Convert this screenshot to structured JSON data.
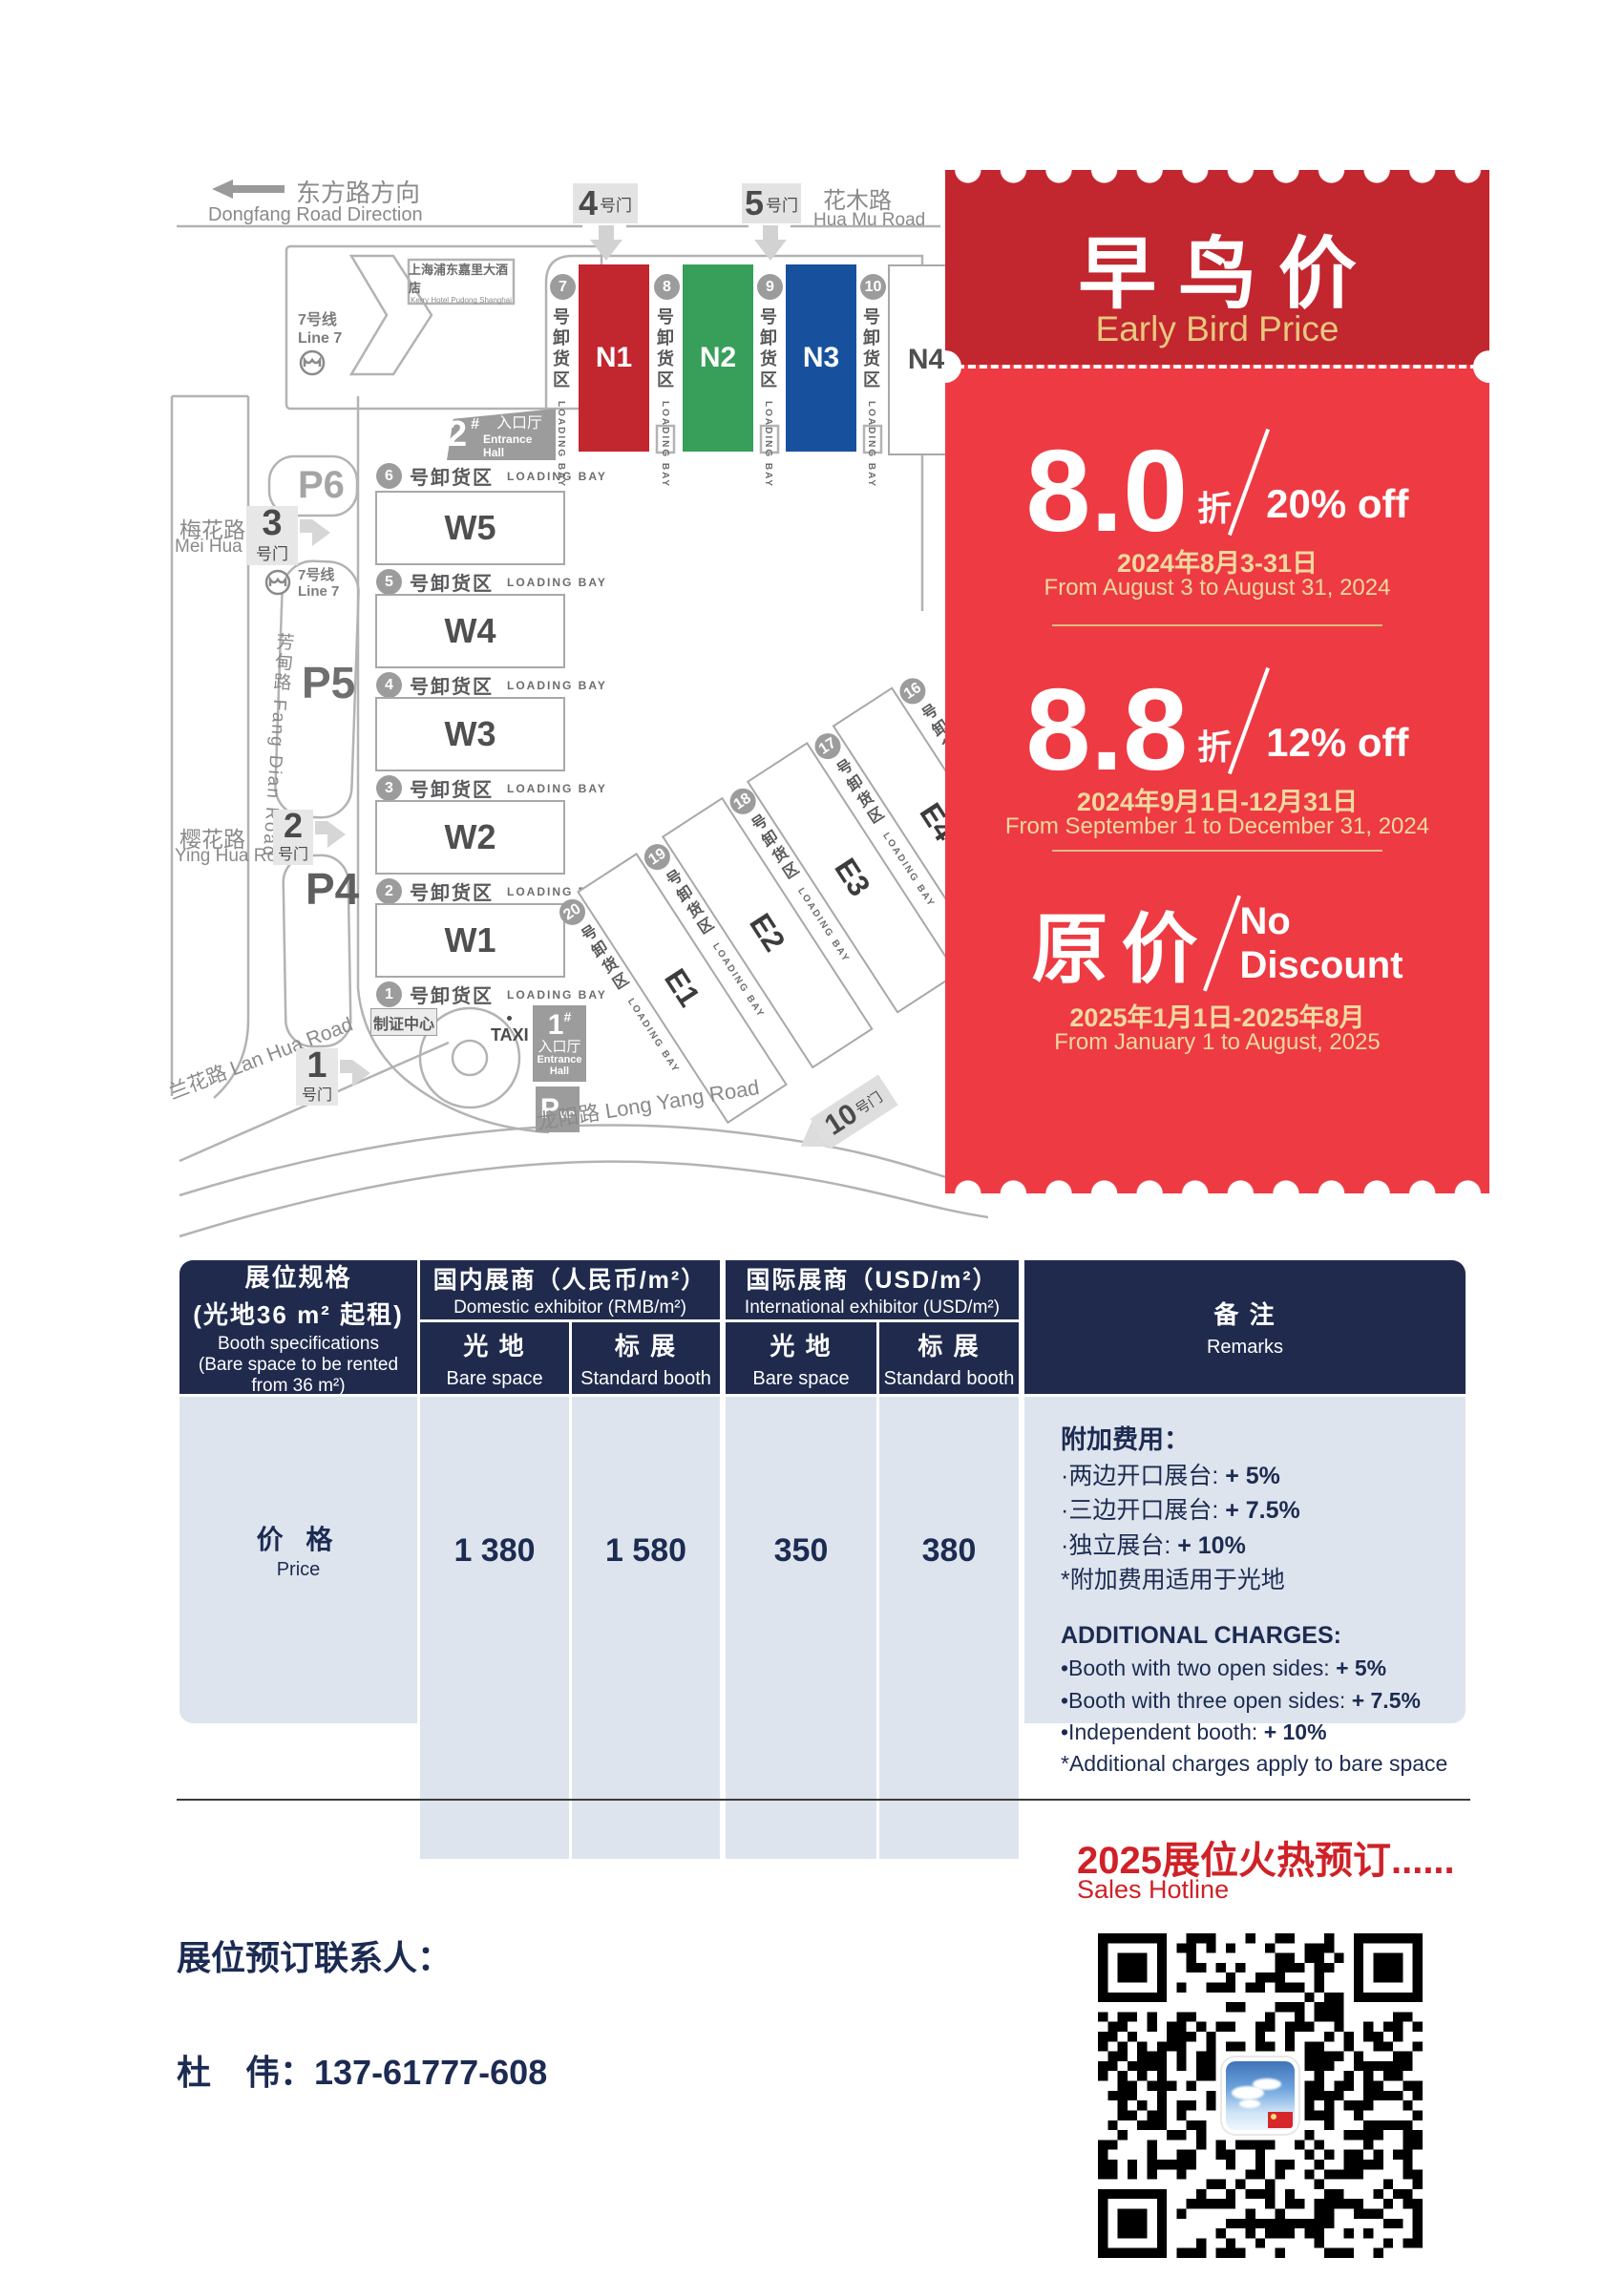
{
  "map": {
    "direction_cn": "东方路方向",
    "direction_en": "Dongfang Road Direction",
    "huamu_cn": "花木路",
    "huamu_en": "Hua Mu Road",
    "meihua_cn": "梅花路",
    "meihua_en": "Mei Hua Road",
    "yinghua_cn": "樱花路",
    "yinghua_en": "Ying Hua Road",
    "lanhua": "兰花路 Lan Hua Road",
    "fangdian": "芳甸路 Fang Dian Road",
    "longyang": "龙阳路  Long Yang Road",
    "metro_cn": "7号线",
    "metro_en": "Line 7",
    "hotel_cn": "上海浦东嘉里大酒店",
    "hotel_en": "Kerry Hotel Pudong Shanghai",
    "gate_suffix": "号门",
    "gates": {
      "g1": "1",
      "g2": "2",
      "g3": "3",
      "g4": "4",
      "g5": "5",
      "g10": "10"
    },
    "parking": {
      "p4": "P4",
      "p5": "P5",
      "p6": "P6",
      "vip_p": "P",
      "vip_sub": "VIP"
    },
    "entrance2_num": "2",
    "entrance1_num": "1",
    "entrance_hash": "#",
    "entrance_cn": "入口厅",
    "entrance_en": "Entrance Hall",
    "badge_center": "制证中心",
    "taxi": "TAXI",
    "bay_cn": "号卸货区",
    "bay_en": "LOADING BAY",
    "n": {
      "b1": "7",
      "h1": "N1",
      "b2": "8",
      "h2": "N2",
      "b3": "9",
      "h3": "N3",
      "b4": "10",
      "h4": "N4"
    },
    "w": {
      "b1": "6",
      "h1": "W5",
      "b2": "5",
      "h2": "W4",
      "b3": "4",
      "h3": "W3",
      "b4": "3",
      "h4": "W2",
      "b5": "2",
      "h5": "W1",
      "b6": "1"
    },
    "e": {
      "b1": "20",
      "h1": "E1",
      "b2": "19",
      "h2": "E2",
      "b3": "18",
      "h3": "E3",
      "b4": "17",
      "h4": "E4",
      "b5": "16"
    },
    "hall_colors": {
      "n1": "#c2262e",
      "n2": "#379f5a",
      "n3": "#17519e"
    }
  },
  "coupon": {
    "title_cn": "早 鸟 价",
    "title_en": "Early Bird Price",
    "tier1": {
      "big": "8.0",
      "unit": "折",
      "off": "20% off",
      "date_cn": "2024年8月3-31日",
      "date_en": "From August 3 to August 31, 2024"
    },
    "tier2": {
      "big": "8.8",
      "unit": "折",
      "off": "12% off",
      "date_cn": "2024年9月1日-12月31日",
      "date_en": "From September 1 to December 31, 2024"
    },
    "tier3": {
      "big": "原价",
      "off1": "No",
      "off2": "Discount",
      "date_cn": "2025年1月1日-2025年8月",
      "date_en": "From January 1 to August, 2025"
    },
    "colors": {
      "dark_red": "#c2262e",
      "bright_red": "#ee3a42",
      "gold": "#e7c87f"
    }
  },
  "pricing_table": {
    "spec": {
      "l1": "展位规格",
      "l2": "(光地36 m² 起租)",
      "l3": "Booth specifications",
      "l4": "(Bare space to be rented",
      "l5": "from 36 m²)"
    },
    "group_domestic_cn": "国内展商（人民币/m²）",
    "group_domestic_en": "Domestic exhibitor (RMB/m²)",
    "group_intl_cn": "国际展商（USD/m²）",
    "group_intl_en": "International exhibitor (USD/m²)",
    "col_bare_cn": "光 地",
    "col_bare_en": "Bare space",
    "col_std_cn": "标 展",
    "col_std_en": "Standard booth",
    "remarks_cn": "备 注",
    "remarks_en": "Remarks",
    "price_label_cn": "价 格",
    "price_label_en": "Price",
    "values": {
      "dom_bare": "1 380",
      "dom_std": "1 580",
      "intl_bare": "350",
      "intl_std": "380"
    },
    "remarks": {
      "cn_title": "附加费用：",
      "cn1t": "·两边开口展台: ",
      "cn1b": "+ 5%",
      "cn2t": "·三边开口展台: ",
      "cn2b": "+ 7.5%",
      "cn3t": "·独立展台: ",
      "cn3b": "+ 10%",
      "cn4": "*附加费用适用于光地",
      "en_title": "ADDITIONAL CHARGES:",
      "en1t": "•Booth with two open sides: ",
      "en1b": "+ 5%",
      "en2t": "•Booth with three open sides: ",
      "en2b": "+ 7.5%",
      "en3t": "•Independent booth: ",
      "en3b": "+ 10%",
      "en4": "*Additional charges apply to bare space"
    }
  },
  "footer": {
    "hotline_cn": "2025展位火热预订......",
    "hotline_en": "Sales Hotline",
    "contact_label": "展位预订联系人：",
    "contact": "杜　伟：137-61777-608"
  }
}
